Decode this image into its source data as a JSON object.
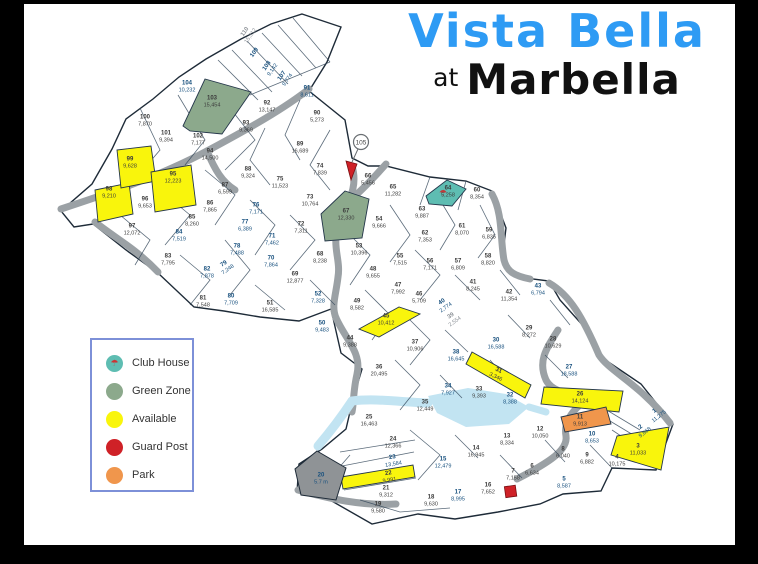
{
  "title": {
    "line1": "Vista Bella",
    "line2_prefix": "at",
    "line2": "Marbella"
  },
  "colors": {
    "title_blue": "#2e9bf4",
    "available": "#f9f50c",
    "green_zone": "#8ca98c",
    "club_house": "#5ebdb2",
    "guard_post": "#cf2127",
    "park": "#f0964c",
    "gray_plot": "#8f9396",
    "road": "#9ba1a5",
    "water": "#c2e4f2",
    "boundary": "#33475a",
    "ink_blue": "#17507e",
    "ink_dark": "#3c3c3c"
  },
  "legend": {
    "items": [
      {
        "key": "club_house",
        "label": "Club House"
      },
      {
        "key": "green_zone",
        "label": "Green Zone"
      },
      {
        "key": "available",
        "label": "Available"
      },
      {
        "key": "guard_post",
        "label": "Guard Post"
      },
      {
        "key": "park",
        "label": "Park"
      }
    ]
  },
  "map": {
    "guard_node": {
      "label": "105",
      "x": 361,
      "y": 142
    },
    "plots": [
      {
        "n": "110",
        "a": "15,312",
        "x": 248,
        "y": 34,
        "ink": "gray",
        "rot": -55
      },
      {
        "n": "109",
        "a": "",
        "x": 255,
        "y": 53,
        "ink": "blue",
        "rot": -55
      },
      {
        "n": "108",
        "a": "9,142",
        "x": 270,
        "y": 68,
        "ink": "blue",
        "rot": -55
      },
      {
        "n": "107",
        "a": "9,774",
        "x": 285,
        "y": 78,
        "ink": "blue",
        "rot": -55
      },
      {
        "n": "104",
        "a": "10,232",
        "x": 187,
        "y": 87,
        "ink": "blue",
        "rot": 0
      },
      {
        "n": "103",
        "a": "15,454",
        "x": 212,
        "y": 102,
        "ink": "dark",
        "rot": 0
      },
      {
        "n": "91",
        "a": "8,611",
        "x": 307,
        "y": 92,
        "ink": "blue",
        "rot": 0
      },
      {
        "n": "92",
        "a": "13,147",
        "x": 267,
        "y": 107,
        "ink": "dark",
        "rot": 0
      },
      {
        "n": "90",
        "a": "5,273",
        "x": 317,
        "y": 117,
        "ink": "dark",
        "rot": 0
      },
      {
        "n": "93",
        "a": "9,369",
        "x": 246,
        "y": 127,
        "ink": "dark",
        "rot": 0
      },
      {
        "n": "100",
        "a": "7,870",
        "x": 145,
        "y": 121,
        "ink": "dark",
        "rot": 0
      },
      {
        "n": "101",
        "a": "9,394",
        "x": 166,
        "y": 137,
        "ink": "dark",
        "rot": 0
      },
      {
        "n": "102",
        "a": "7,177",
        "x": 198,
        "y": 140,
        "ink": "dark",
        "rot": 0
      },
      {
        "n": "94",
        "a": "14,500",
        "x": 210,
        "y": 155,
        "ink": "dark",
        "rot": 0
      },
      {
        "n": "89",
        "a": "16,689",
        "x": 300,
        "y": 148,
        "ink": "dark",
        "rot": 0
      },
      {
        "n": "99",
        "a": "9,628",
        "x": 130,
        "y": 163,
        "ink": "dark",
        "rot": 0
      },
      {
        "n": "95",
        "a": "12,223",
        "x": 173,
        "y": 178,
        "ink": "dark",
        "rot": 0
      },
      {
        "n": "98",
        "a": "9,210",
        "x": 109,
        "y": 193,
        "ink": "dark",
        "rot": 0
      },
      {
        "n": "96",
        "a": "9,653",
        "x": 145,
        "y": 203,
        "ink": "dark",
        "rot": 0
      },
      {
        "n": "97",
        "a": "12,072",
        "x": 132,
        "y": 230,
        "ink": "dark",
        "rot": 0
      },
      {
        "n": "88",
        "a": "9,324",
        "x": 248,
        "y": 173,
        "ink": "dark",
        "rot": 0
      },
      {
        "n": "87",
        "a": "6,599",
        "x": 225,
        "y": 189,
        "ink": "dark",
        "rot": 0
      },
      {
        "n": "86",
        "a": "7,865",
        "x": 210,
        "y": 207,
        "ink": "dark",
        "rot": 0
      },
      {
        "n": "85",
        "a": "8,260",
        "x": 192,
        "y": 221,
        "ink": "dark",
        "rot": 0
      },
      {
        "n": "84",
        "a": "7,519",
        "x": 179,
        "y": 236,
        "ink": "blue",
        "rot": 0
      },
      {
        "n": "83",
        "a": "7,795",
        "x": 168,
        "y": 260,
        "ink": "dark",
        "rot": 0
      },
      {
        "n": "82",
        "a": "7,878",
        "x": 207,
        "y": 273,
        "ink": "blue",
        "rot": 0
      },
      {
        "n": "81",
        "a": "7,548",
        "x": 203,
        "y": 302,
        "ink": "dark",
        "rot": 0
      },
      {
        "n": "80",
        "a": "7,709",
        "x": 231,
        "y": 300,
        "ink": "blue",
        "rot": 0
      },
      {
        "n": "74",
        "a": "7,839",
        "x": 320,
        "y": 170,
        "ink": "dark",
        "rot": 0
      },
      {
        "n": "66",
        "a": "5,456",
        "x": 368,
        "y": 180,
        "ink": "dark",
        "rot": 0
      },
      {
        "n": "75",
        "a": "11,523",
        "x": 280,
        "y": 183,
        "ink": "dark",
        "rot": 0
      },
      {
        "n": "73",
        "a": "10,764",
        "x": 310,
        "y": 201,
        "ink": "dark",
        "rot": 0
      },
      {
        "n": "76",
        "a": "7,171",
        "x": 256,
        "y": 209,
        "ink": "blue",
        "rot": 0
      },
      {
        "n": "77",
        "a": "6,389",
        "x": 245,
        "y": 226,
        "ink": "blue",
        "rot": 0
      },
      {
        "n": "72",
        "a": "7,311",
        "x": 301,
        "y": 228,
        "ink": "dark",
        "rot": 0
      },
      {
        "n": "71",
        "a": "7,462",
        "x": 272,
        "y": 240,
        "ink": "blue",
        "rot": 0
      },
      {
        "n": "78",
        "a": "7,488",
        "x": 237,
        "y": 250,
        "ink": "blue",
        "rot": 0
      },
      {
        "n": "79",
        "a": "7,248",
        "x": 226,
        "y": 267,
        "ink": "blue",
        "rot": -35
      },
      {
        "n": "70",
        "a": "7,864",
        "x": 271,
        "y": 262,
        "ink": "blue",
        "rot": 0
      },
      {
        "n": "68",
        "a": "8,238",
        "x": 320,
        "y": 258,
        "ink": "dark",
        "rot": 0
      },
      {
        "n": "69",
        "a": "12,877",
        "x": 295,
        "y": 278,
        "ink": "dark",
        "rot": 0
      },
      {
        "n": "51",
        "a": "16,585",
        "x": 270,
        "y": 307,
        "ink": "dark",
        "rot": 0
      },
      {
        "n": "52",
        "a": "7,328",
        "x": 318,
        "y": 298,
        "ink": "blue",
        "rot": 0
      },
      {
        "n": "50",
        "a": "9,483",
        "x": 322,
        "y": 327,
        "ink": "blue",
        "rot": 0
      },
      {
        "n": "67",
        "a": "12,330",
        "x": 346,
        "y": 215,
        "ink": "dark",
        "rot": 0
      },
      {
        "n": "65",
        "a": "11,282",
        "x": 393,
        "y": 191,
        "ink": "dark",
        "rot": 0
      },
      {
        "n": "64",
        "a": "5,258",
        "x": 448,
        "y": 192,
        "ink": "dark",
        "rot": 0
      },
      {
        "n": "60",
        "a": "8,354",
        "x": 477,
        "y": 194,
        "ink": "dark",
        "rot": 0
      },
      {
        "n": "63",
        "a": "9,887",
        "x": 422,
        "y": 213,
        "ink": "dark",
        "rot": 0
      },
      {
        "n": "54",
        "a": "9,666",
        "x": 379,
        "y": 223,
        "ink": "dark",
        "rot": 0
      },
      {
        "n": "61",
        "a": "8,070",
        "x": 462,
        "y": 230,
        "ink": "dark",
        "rot": 0
      },
      {
        "n": "59",
        "a": "6,835",
        "x": 489,
        "y": 234,
        "ink": "dark",
        "rot": 0
      },
      {
        "n": "62",
        "a": "7,353",
        "x": 425,
        "y": 237,
        "ink": "dark",
        "rot": 0
      },
      {
        "n": "53",
        "a": "10,396",
        "x": 359,
        "y": 250,
        "ink": "dark",
        "rot": 0
      },
      {
        "n": "55",
        "a": "7,515",
        "x": 400,
        "y": 260,
        "ink": "dark",
        "rot": 0
      },
      {
        "n": "56",
        "a": "7,171",
        "x": 430,
        "y": 265,
        "ink": "dark",
        "rot": 0
      },
      {
        "n": "57",
        "a": "6,809",
        "x": 458,
        "y": 265,
        "ink": "dark",
        "rot": 0
      },
      {
        "n": "58",
        "a": "8,820",
        "x": 488,
        "y": 260,
        "ink": "dark",
        "rot": 0
      },
      {
        "n": "48",
        "a": "9,655",
        "x": 373,
        "y": 273,
        "ink": "dark",
        "rot": 0
      },
      {
        "n": "47",
        "a": "7,992",
        "x": 398,
        "y": 289,
        "ink": "dark",
        "rot": 0
      },
      {
        "n": "46",
        "a": "5,709",
        "x": 419,
        "y": 298,
        "ink": "dark",
        "rot": 0
      },
      {
        "n": "41",
        "a": "8,245",
        "x": 473,
        "y": 286,
        "ink": "dark",
        "rot": 0
      },
      {
        "n": "42",
        "a": "11,354",
        "x": 509,
        "y": 296,
        "ink": "dark",
        "rot": 0
      },
      {
        "n": "43",
        "a": "6,794",
        "x": 538,
        "y": 290,
        "ink": "blue",
        "rot": 0
      },
      {
        "n": "49",
        "a": "8,582",
        "x": 357,
        "y": 305,
        "ink": "dark",
        "rot": 0
      },
      {
        "n": "45",
        "a": "10,412",
        "x": 386,
        "y": 320,
        "ink": "dark",
        "rot": 0
      },
      {
        "n": "44",
        "a": "9,388",
        "x": 350,
        "y": 342,
        "ink": "dark",
        "rot": 0
      },
      {
        "n": "40",
        "a": "2,774",
        "x": 444,
        "y": 305,
        "ink": "blue",
        "rot": -35
      },
      {
        "n": "39",
        "a": "2,554",
        "x": 453,
        "y": 319,
        "ink": "gray",
        "rot": -35
      },
      {
        "n": "29",
        "a": "8,272",
        "x": 529,
        "y": 332,
        "ink": "dark",
        "rot": 0
      },
      {
        "n": "28",
        "a": "10,629",
        "x": 553,
        "y": 343,
        "ink": "dark",
        "rot": 0
      },
      {
        "n": "37",
        "a": "10,906",
        "x": 415,
        "y": 346,
        "ink": "dark",
        "rot": 0
      },
      {
        "n": "38",
        "a": "16,645",
        "x": 456,
        "y": 356,
        "ink": "blue",
        "rot": 0
      },
      {
        "n": "30",
        "a": "16,588",
        "x": 496,
        "y": 344,
        "ink": "blue",
        "rot": 0
      },
      {
        "n": "27",
        "a": "18,588",
        "x": 569,
        "y": 371,
        "ink": "blue",
        "rot": 0
      },
      {
        "n": "36",
        "a": "20,495",
        "x": 379,
        "y": 371,
        "ink": "dark",
        "rot": 0
      },
      {
        "n": "31",
        "a": "3,346",
        "x": 497,
        "y": 374,
        "ink": "dark",
        "rot": 25
      },
      {
        "n": "34",
        "a": "7,927",
        "x": 448,
        "y": 390,
        "ink": "blue",
        "rot": 0
      },
      {
        "n": "33",
        "a": "9,393",
        "x": 479,
        "y": 393,
        "ink": "dark",
        "rot": 0
      },
      {
        "n": "32",
        "a": "8,388",
        "x": 510,
        "y": 399,
        "ink": "blue",
        "rot": 0
      },
      {
        "n": "26",
        "a": "14,124",
        "x": 580,
        "y": 398,
        "ink": "dark",
        "rot": 0
      },
      {
        "n": "35",
        "a": "12,449",
        "x": 425,
        "y": 406,
        "ink": "dark",
        "rot": 0
      },
      {
        "n": "25",
        "a": "16,463",
        "x": 369,
        "y": 421,
        "ink": "dark",
        "rot": 0
      },
      {
        "n": "11",
        "a": "9,913",
        "x": 580,
        "y": 421,
        "ink": "dark",
        "rot": 0
      },
      {
        "n": "24",
        "a": "12,366",
        "x": 393,
        "y": 443,
        "ink": "dark",
        "rot": 0
      },
      {
        "n": "23",
        "a": "13,584",
        "x": 393,
        "y": 461,
        "ink": "blue",
        "rot": -9
      },
      {
        "n": "22",
        "a": "9,991",
        "x": 389,
        "y": 477,
        "ink": "dark",
        "rot": -9
      },
      {
        "n": "21",
        "a": "9,312",
        "x": 386,
        "y": 492,
        "ink": "dark",
        "rot": 0
      },
      {
        "n": "19",
        "a": "9,580",
        "x": 378,
        "y": 508,
        "ink": "dark",
        "rot": 0
      },
      {
        "n": "18",
        "a": "9,630",
        "x": 431,
        "y": 501,
        "ink": "dark",
        "rot": 0
      },
      {
        "n": "20",
        "a": "5.7 m",
        "x": 321,
        "y": 479,
        "ink": "blue",
        "rot": 0
      },
      {
        "n": "15",
        "a": "12,479",
        "x": 443,
        "y": 463,
        "ink": "blue",
        "rot": 0
      },
      {
        "n": "14",
        "a": "16,945",
        "x": 476,
        "y": 452,
        "ink": "dark",
        "rot": 0
      },
      {
        "n": "13",
        "a": "8,334",
        "x": 507,
        "y": 440,
        "ink": "dark",
        "rot": 0
      },
      {
        "n": "17",
        "a": "8,995",
        "x": 458,
        "y": 496,
        "ink": "blue",
        "rot": 0
      },
      {
        "n": "16",
        "a": "7,652",
        "x": 488,
        "y": 489,
        "ink": "dark",
        "rot": 0
      },
      {
        "n": "12",
        "a": "10,050",
        "x": 540,
        "y": 433,
        "ink": "dark",
        "rot": 0
      },
      {
        "n": "7",
        "a": "7,158",
        "x": 513,
        "y": 475,
        "ink": "dark",
        "rot": 0
      },
      {
        "n": "6",
        "a": "6,634",
        "x": 532,
        "y": 470,
        "ink": "dark",
        "rot": 0
      },
      {
        "n": "8",
        "a": "6,040",
        "x": 563,
        "y": 453,
        "ink": "dark",
        "rot": 0
      },
      {
        "n": "9",
        "a": "6,882",
        "x": 587,
        "y": 459,
        "ink": "dark",
        "rot": 0
      },
      {
        "n": "5",
        "a": "8,587",
        "x": 564,
        "y": 483,
        "ink": "blue",
        "rot": 0
      },
      {
        "n": "10",
        "a": "8,653",
        "x": 592,
        "y": 438,
        "ink": "blue",
        "rot": 0
      },
      {
        "n": "4",
        "a": "10,175",
        "x": 617,
        "y": 461,
        "ink": "dark",
        "rot": 0
      },
      {
        "n": "3",
        "a": "11,033",
        "x": 638,
        "y": 450,
        "ink": "dark",
        "rot": 0
      },
      {
        "n": "2",
        "a": "9,868",
        "x": 643,
        "y": 430,
        "ink": "blue",
        "rot": -38
      },
      {
        "n": "1",
        "a": "11,275",
        "x": 657,
        "y": 414,
        "ink": "blue",
        "rot": -38
      }
    ]
  }
}
